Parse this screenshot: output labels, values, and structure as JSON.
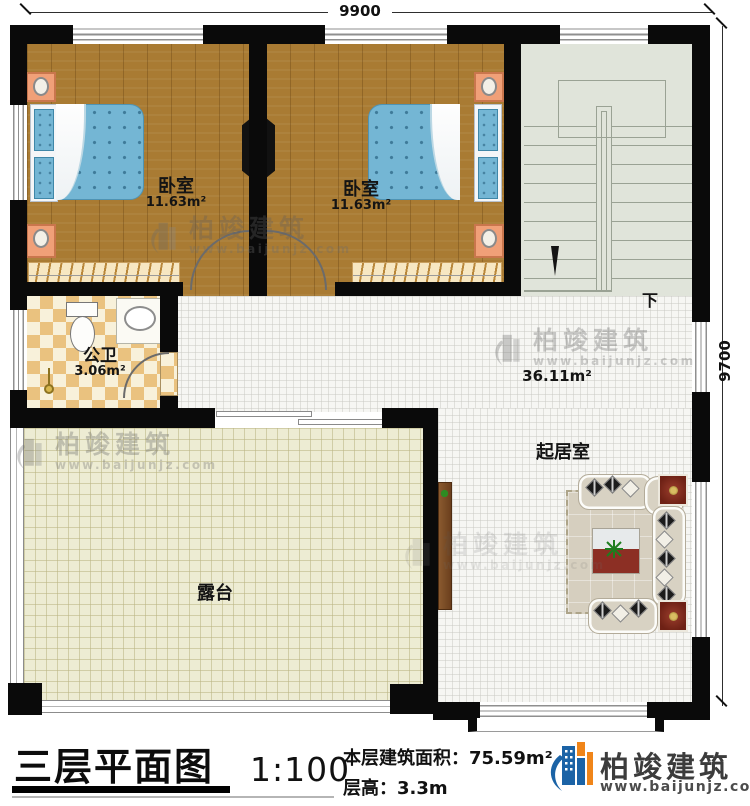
{
  "plan": {
    "dimensions": {
      "top": "9900",
      "right": "9700"
    },
    "rooms": {
      "bedroom_left": {
        "name": "卧室",
        "area": "11.63m²"
      },
      "bedroom_right": {
        "name": "卧室",
        "area": "11.63m²"
      },
      "bathroom": {
        "name": "公卫",
        "area": "3.06m²"
      },
      "living": {
        "name": "起居室",
        "area": "36.11m²"
      },
      "terrace": {
        "name": "露台"
      },
      "stairs": {
        "direction": "下"
      }
    }
  },
  "footer": {
    "title": "三层平面图",
    "scale": "1:100",
    "area_line": "本层建筑面积：75.59m²",
    "height_line": "层高：3.3m",
    "brand": "柏竣建筑",
    "website": "www.baijunjz.com"
  },
  "watermark": {
    "brand": "柏竣建筑",
    "website": "www.baijunjz.com"
  },
  "colors": {
    "wall": "#0a0a0a",
    "wood_floor": "#a97b33",
    "bathroom_tile": "#eac27f",
    "stair_floor": "#e0e4da",
    "terrace_floor": "#edecd3",
    "living_floor": "#f6f6f3",
    "bed_blue": "#74b6d4",
    "brand_blue": "#1b63a6",
    "brand_orange": "#f08519"
  }
}
